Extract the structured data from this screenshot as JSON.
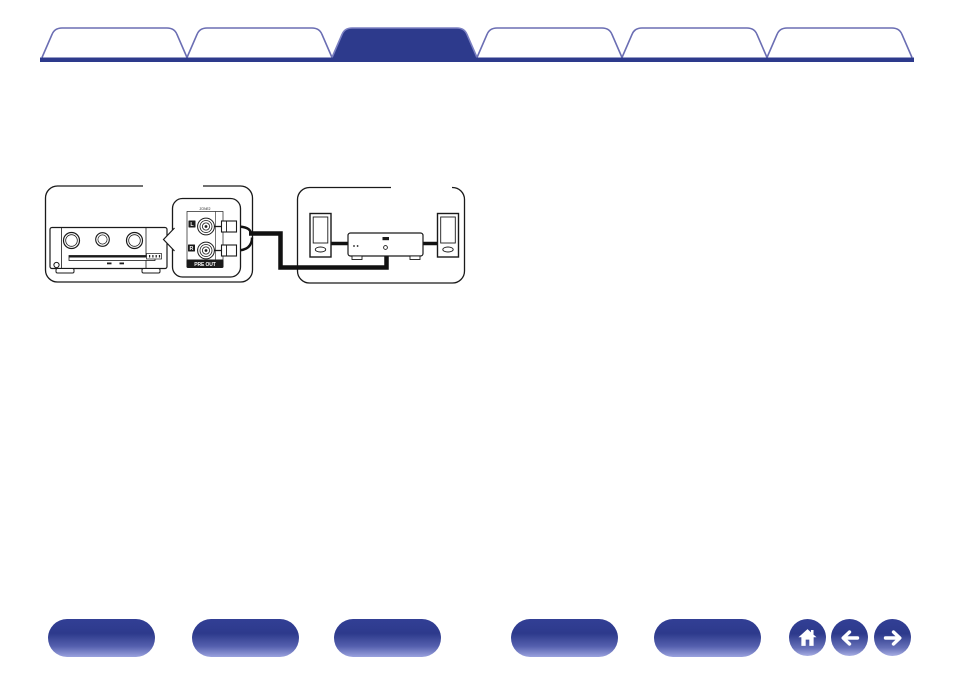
{
  "theme": {
    "accent": "#2d3a8c",
    "tab_outline": "#6b6eb3",
    "active_tab_outline": "#7b80c2",
    "diagram_ink": "#1a1a1a",
    "nav_button_gradient_top": "#2d3a8c",
    "nav_button_gradient_bottom": "#9aa2de"
  },
  "header": {
    "tabs": [
      {
        "name": "section-tab-1",
        "label": "",
        "active": false
      },
      {
        "name": "section-tab-2",
        "label": "",
        "active": false
      },
      {
        "name": "section-tab-3",
        "label": "",
        "active": true
      },
      {
        "name": "section-tab-4",
        "label": "",
        "active": false
      },
      {
        "name": "section-tab-5",
        "label": "",
        "active": false
      },
      {
        "name": "section-tab-6",
        "label": "",
        "active": false
      }
    ]
  },
  "diagram": {
    "callout": {
      "zone_label": "ZONE2",
      "channel_left": "L",
      "channel_right": "R",
      "preout_label": "PRE OUT"
    }
  },
  "footer": {
    "section_buttons": [
      {
        "name": "footer-section-1",
        "label": ""
      },
      {
        "name": "footer-section-2",
        "label": ""
      },
      {
        "name": "footer-section-3",
        "label": ""
      },
      {
        "name": "footer-section-4",
        "label": ""
      },
      {
        "name": "footer-section-5",
        "label": ""
      }
    ],
    "nav_buttons": [
      {
        "name": "home",
        "icon": "home-icon"
      },
      {
        "name": "back",
        "icon": "arrow-left-icon"
      },
      {
        "name": "forward",
        "icon": "arrow-right-icon"
      }
    ]
  }
}
